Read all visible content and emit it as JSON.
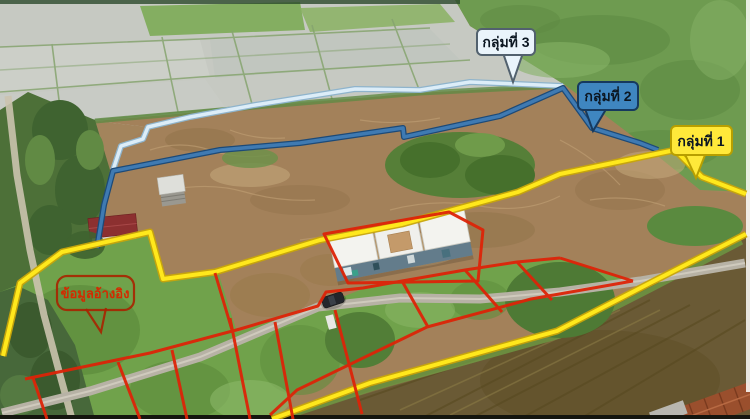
{
  "callouts": {
    "group1": {
      "label": "กลุ่มที่ 1",
      "fill": "#ffe93a",
      "border": "#b89f00",
      "line": "#ffe81c"
    },
    "group2": {
      "label": "กลุ่มที่ 2",
      "fill": "#3f86c0",
      "border": "#16395e",
      "line": "#3f7ab2"
    },
    "group3": {
      "label": "กลุ่มที่ 3",
      "fill": "#eaf4fb",
      "border": "#52616e",
      "line": "#dcedf8"
    },
    "reference": {
      "label": "ข้อมูลอ้างอิง",
      "color": "#d32b00"
    }
  },
  "plot_lines": {
    "color": "#dd2408"
  }
}
